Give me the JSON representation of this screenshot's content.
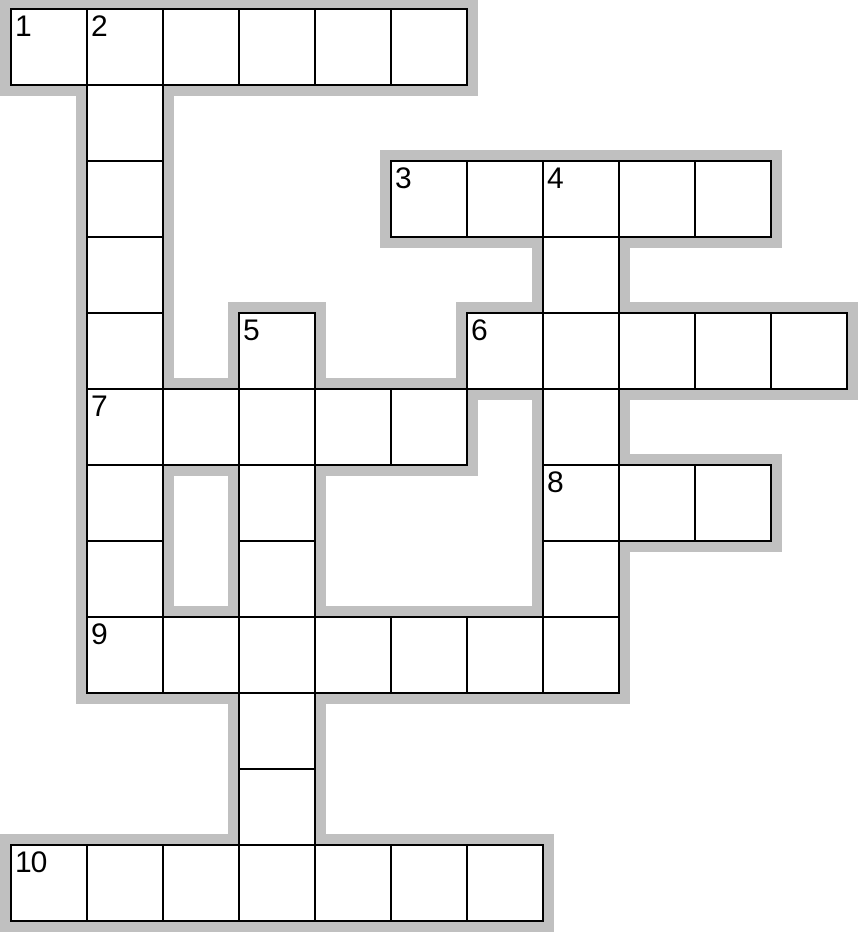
{
  "page": {
    "title": "crossword-grid",
    "background": "#ffffff",
    "width": 864,
    "height": 941
  },
  "puzzle": {
    "outline_color": "#c0c0c0",
    "cell_fill": "#ffffff",
    "line_color": "#000000",
    "number_color": "#000000",
    "grid": {
      "origin_x": 11,
      "origin_y": 9,
      "cell_size": 76,
      "outline_thickness": 11,
      "line_thickness": 2
    },
    "words": [
      {
        "number": "1",
        "direction": "across",
        "col": 0,
        "row": 0,
        "length": 6
      },
      {
        "number": "2",
        "direction": "down",
        "col": 1,
        "row": 0,
        "length": 9
      },
      {
        "number": "3",
        "direction": "across",
        "col": 5,
        "row": 2,
        "length": 5
      },
      {
        "number": "4",
        "direction": "down",
        "col": 7,
        "row": 2,
        "length": 7
      },
      {
        "number": "5",
        "direction": "down",
        "col": 3,
        "row": 4,
        "length": 8
      },
      {
        "number": "6",
        "direction": "across",
        "col": 6,
        "row": 4,
        "length": 5
      },
      {
        "number": "7",
        "direction": "across",
        "col": 1,
        "row": 5,
        "length": 5
      },
      {
        "number": "8",
        "direction": "across",
        "col": 7,
        "row": 6,
        "length": 3
      },
      {
        "number": "9",
        "direction": "across",
        "col": 1,
        "row": 8,
        "length": 7
      },
      {
        "number": "10",
        "direction": "across",
        "col": 0,
        "row": 11,
        "length": 7
      }
    ]
  }
}
